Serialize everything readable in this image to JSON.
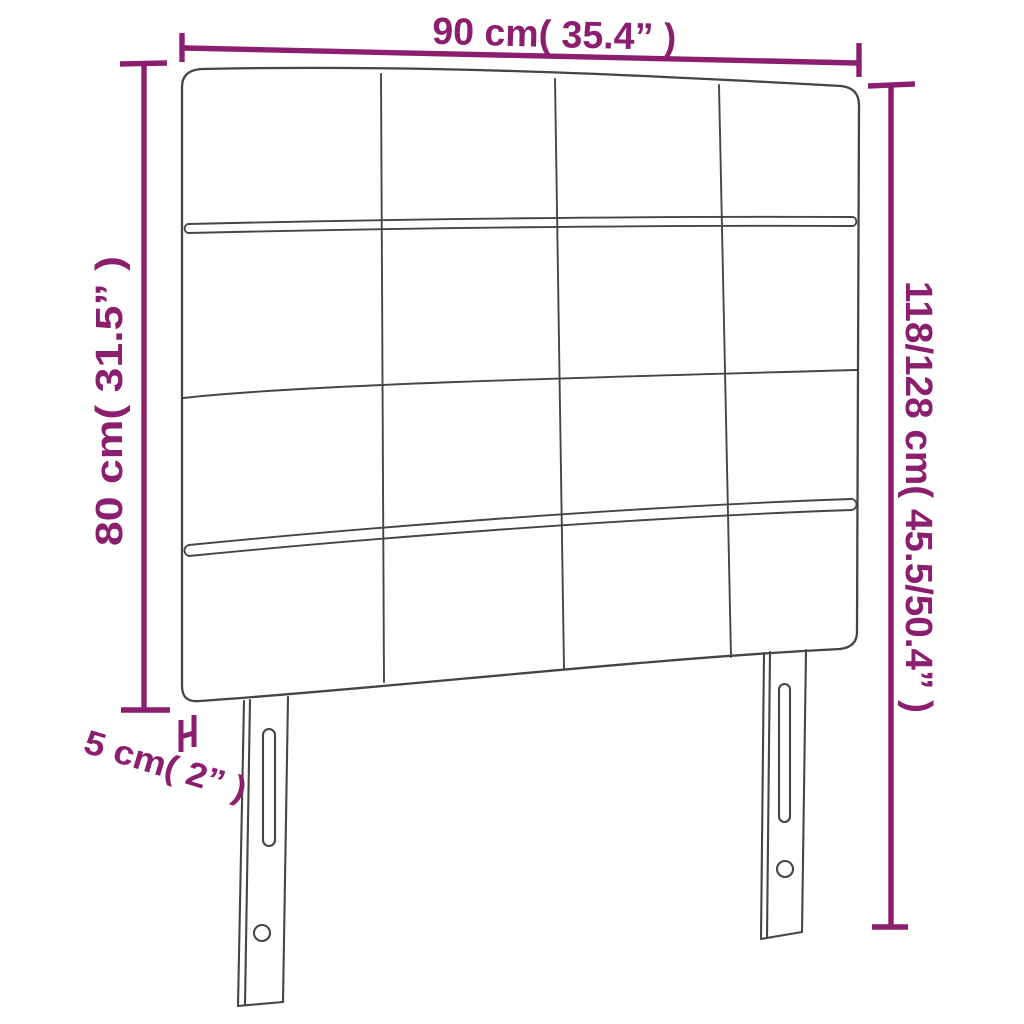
{
  "diagram": {
    "type": "furniture-dimension-diagram",
    "subject": "Tufted headboard with 4x4 square panels and two slotted mounting legs",
    "colors": {
      "dimension_accent": "#8B1E6F",
      "drawing_outline": "#454545",
      "background": "#FFFFFF"
    },
    "panel_grid": {
      "rows": 4,
      "columns": 4
    },
    "dimensions": {
      "width": {
        "label": "90 cm( 35.4” )",
        "cm": "90",
        "inch": "35.4",
        "position": "top"
      },
      "headboard_height": {
        "label": "80 cm( 31.5” )",
        "cm": "80",
        "inch": "31.5",
        "position": "left"
      },
      "total_height": {
        "label": "118/128 cm( 45.5/50.4” )",
        "cm": "118/128",
        "inch": "45.5/50.4",
        "position": "right"
      },
      "thickness": {
        "label": "5 cm( 2” )",
        "cm": "5",
        "inch": "2",
        "position": "bottom-left"
      }
    }
  }
}
